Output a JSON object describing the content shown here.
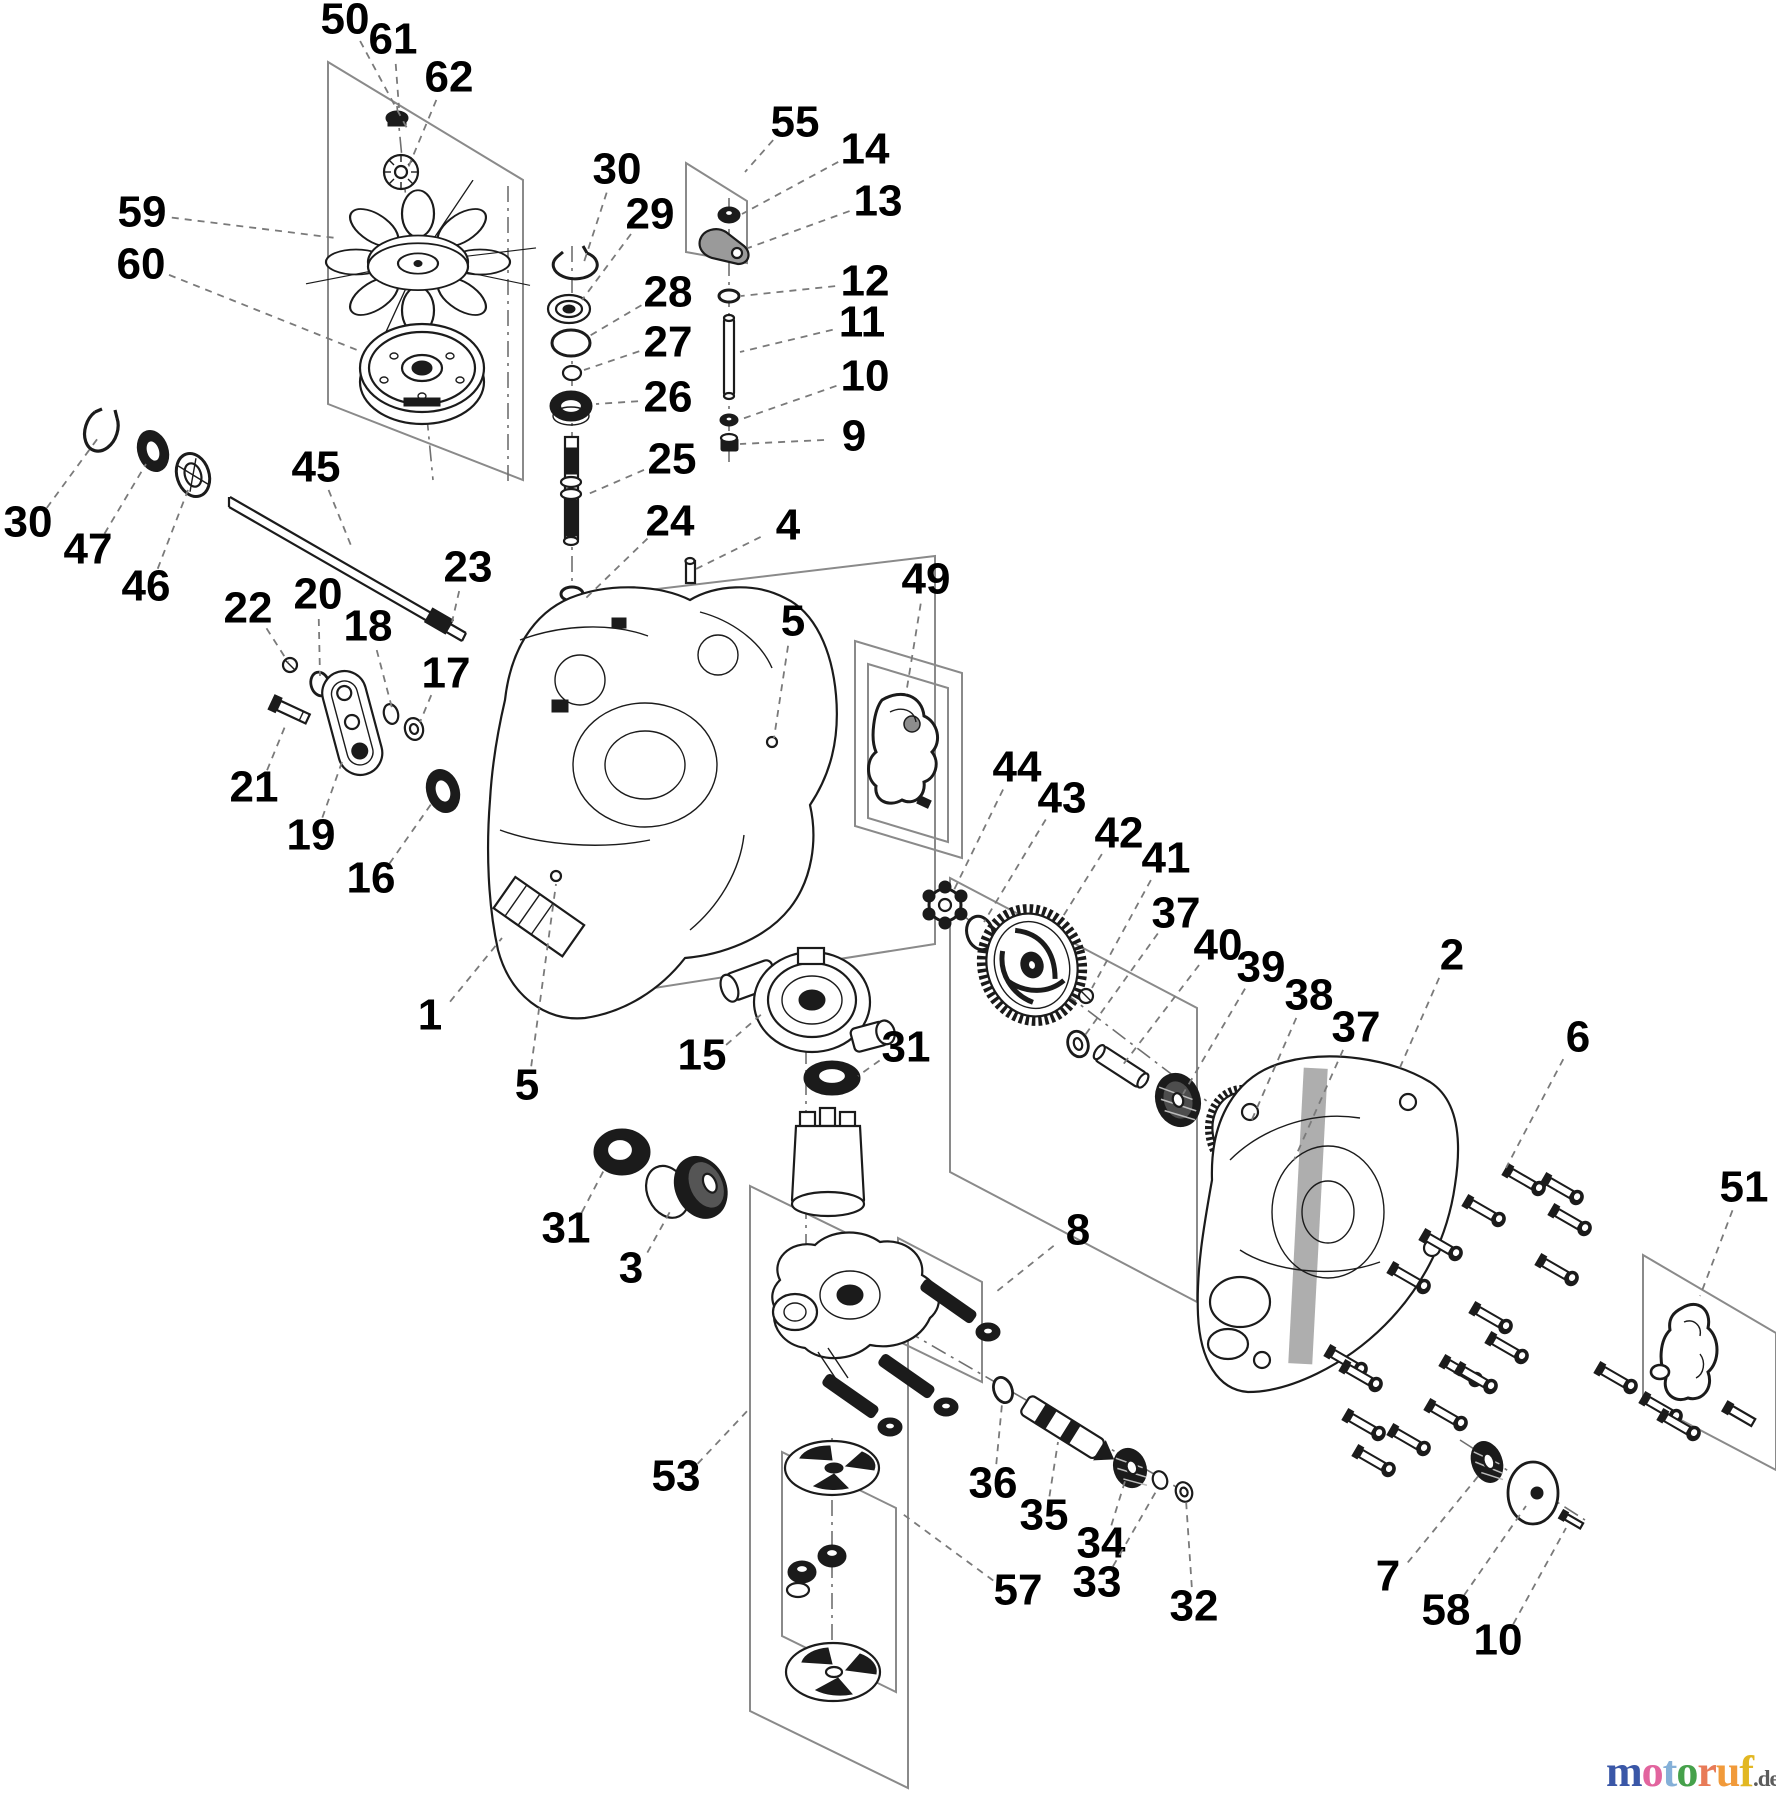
{
  "diagram": {
    "type": "exploded-parts-diagram",
    "description": "Hydrostatic transaxle exploded view with numbered part callouts",
    "background": "#ffffff",
    "line_color": "#1b1b1b",
    "leader_color": "#7a7a7a",
    "box_color": "#8a8a8a"
  },
  "callouts": [
    {
      "label": "50",
      "x": 345,
      "y": 22,
      "tx": 408,
      "ty": 130
    },
    {
      "label": "61",
      "x": 393,
      "y": 42,
      "tx": 399,
      "ty": 108
    },
    {
      "label": "62",
      "x": 449,
      "y": 80,
      "tx": 408,
      "ty": 168
    },
    {
      "label": "59",
      "x": 142,
      "y": 215,
      "tx": 336,
      "ty": 238
    },
    {
      "label": "60",
      "x": 141,
      "y": 267,
      "tx": 362,
      "ty": 352
    },
    {
      "label": "30",
      "x": 617,
      "y": 172,
      "tx": 584,
      "ty": 262
    },
    {
      "label": "29",
      "x": 650,
      "y": 217,
      "tx": 582,
      "ty": 300
    },
    {
      "label": "28",
      "x": 668,
      "y": 295,
      "tx": 586,
      "ty": 338
    },
    {
      "label": "27",
      "x": 668,
      "y": 345,
      "tx": 584,
      "ty": 370
    },
    {
      "label": "26",
      "x": 668,
      "y": 400,
      "tx": 596,
      "ty": 404
    },
    {
      "label": "25",
      "x": 672,
      "y": 462,
      "tx": 586,
      "ty": 495
    },
    {
      "label": "24",
      "x": 670,
      "y": 524,
      "tx": 586,
      "ty": 598
    },
    {
      "label": "23",
      "x": 468,
      "y": 570,
      "tx": 452,
      "ty": 622
    },
    {
      "label": "55",
      "x": 795,
      "y": 125,
      "tx": 745,
      "ty": 172
    },
    {
      "label": "14",
      "x": 865,
      "y": 152,
      "tx": 742,
      "ty": 214
    },
    {
      "label": "13",
      "x": 878,
      "y": 204,
      "tx": 748,
      "ty": 248
    },
    {
      "label": "12",
      "x": 865,
      "y": 284,
      "tx": 741,
      "ty": 296
    },
    {
      "label": "11",
      "x": 862,
      "y": 325,
      "tx": 740,
      "ty": 352
    },
    {
      "label": "10",
      "x": 865,
      "y": 379,
      "tx": 739,
      "ty": 420
    },
    {
      "label": "9",
      "x": 854,
      "y": 439,
      "tx": 740,
      "ty": 444
    },
    {
      "label": "4",
      "x": 788,
      "y": 528,
      "tx": 694,
      "ty": 570
    },
    {
      "label": "5",
      "x": 793,
      "y": 624,
      "tx": 774,
      "ty": 738
    },
    {
      "label": "49",
      "x": 926,
      "y": 582,
      "tx": 906,
      "ty": 694
    },
    {
      "label": "44",
      "x": 1017,
      "y": 770,
      "tx": 952,
      "ty": 894
    },
    {
      "label": "43",
      "x": 1062,
      "y": 801,
      "tx": 984,
      "ty": 922
    },
    {
      "label": "42",
      "x": 1119,
      "y": 836,
      "tx": 1062,
      "ty": 918
    },
    {
      "label": "41",
      "x": 1166,
      "y": 861,
      "tx": 1092,
      "ty": 988
    },
    {
      "label": "37",
      "x": 1176,
      "y": 916,
      "tx": 1083,
      "ty": 1038
    },
    {
      "label": "40",
      "x": 1218,
      "y": 948,
      "tx": 1122,
      "ty": 1066
    },
    {
      "label": "39",
      "x": 1261,
      "y": 970,
      "tx": 1183,
      "ty": 1094
    },
    {
      "label": "38",
      "x": 1309,
      "y": 998,
      "tx": 1250,
      "ty": 1124
    },
    {
      "label": "37",
      "x": 1356,
      "y": 1030,
      "tx": 1294,
      "ty": 1160
    },
    {
      "label": "2",
      "x": 1452,
      "y": 958,
      "tx": 1398,
      "ty": 1072
    },
    {
      "label": "6",
      "x": 1578,
      "y": 1040,
      "tx": 1506,
      "ty": 1168
    },
    {
      "label": "51",
      "x": 1744,
      "y": 1190,
      "tx": 1700,
      "ty": 1296
    },
    {
      "label": "30",
      "x": 28,
      "y": 525,
      "tx": 98,
      "ty": 438
    },
    {
      "label": "47",
      "x": 88,
      "y": 552,
      "tx": 146,
      "ty": 464
    },
    {
      "label": "46",
      "x": 146,
      "y": 589,
      "tx": 188,
      "ty": 490
    },
    {
      "label": "45",
      "x": 316,
      "y": 470,
      "tx": 352,
      "ty": 548
    },
    {
      "label": "22",
      "x": 248,
      "y": 611,
      "tx": 288,
      "ty": 662
    },
    {
      "label": "20",
      "x": 318,
      "y": 597,
      "tx": 320,
      "ty": 676
    },
    {
      "label": "18",
      "x": 368,
      "y": 629,
      "tx": 392,
      "ty": 708
    },
    {
      "label": "17",
      "x": 446,
      "y": 676,
      "tx": 420,
      "ty": 722
    },
    {
      "label": "21",
      "x": 254,
      "y": 790,
      "tx": 286,
      "ty": 724
    },
    {
      "label": "19",
      "x": 311,
      "y": 838,
      "tx": 342,
      "ty": 762
    },
    {
      "label": "16",
      "x": 371,
      "y": 881,
      "tx": 434,
      "ty": 800
    },
    {
      "label": "1",
      "x": 430,
      "y": 1018,
      "tx": 502,
      "ty": 938
    },
    {
      "label": "5",
      "x": 527,
      "y": 1088,
      "tx": 556,
      "ty": 884
    },
    {
      "label": "15",
      "x": 702,
      "y": 1058,
      "tx": 764,
      "ty": 1012
    },
    {
      "label": "31",
      "x": 906,
      "y": 1050,
      "tx": 858,
      "ty": 1076
    },
    {
      "label": "31",
      "x": 566,
      "y": 1231,
      "tx": 604,
      "ty": 1170
    },
    {
      "label": "3",
      "x": 631,
      "y": 1271,
      "tx": 672,
      "ty": 1208
    },
    {
      "label": "8",
      "x": 1078,
      "y": 1233,
      "tx": 996,
      "ty": 1292
    },
    {
      "label": "53",
      "x": 676,
      "y": 1479,
      "tx": 750,
      "ty": 1408
    },
    {
      "label": "36",
      "x": 993,
      "y": 1486,
      "tx": 1002,
      "ty": 1404
    },
    {
      "label": "35",
      "x": 1044,
      "y": 1518,
      "tx": 1058,
      "ty": 1442
    },
    {
      "label": "34",
      "x": 1101,
      "y": 1546,
      "tx": 1126,
      "ty": 1478
    },
    {
      "label": "33",
      "x": 1097,
      "y": 1585,
      "tx": 1158,
      "ty": 1488
    },
    {
      "label": "32",
      "x": 1194,
      "y": 1609,
      "tx": 1186,
      "ty": 1500
    },
    {
      "label": "57",
      "x": 1018,
      "y": 1593,
      "tx": 900,
      "ty": 1512
    },
    {
      "label": "7",
      "x": 1388,
      "y": 1579,
      "tx": 1480,
      "ty": 1474
    },
    {
      "label": "58",
      "x": 1446,
      "y": 1613,
      "tx": 1526,
      "ty": 1506
    },
    {
      "label": "10",
      "x": 1498,
      "y": 1643,
      "tx": 1566,
      "ty": 1528
    }
  ],
  "group_boxes": [
    {
      "name": "box-fan-group-50",
      "points": "328,62 523,180 523,480 328,404"
    },
    {
      "name": "box-bracket-group-55",
      "points": "686,163 747,201 747,263 686,252"
    },
    {
      "name": "box-gasket-49-outer",
      "points": "855,641 962,673 962,858 855,826"
    },
    {
      "name": "box-gasket-49-inner",
      "points": "868,664 948,688 948,842 868,818"
    },
    {
      "name": "box-housing-main",
      "points": "565,600 935,556 935,944 565,1002"
    },
    {
      "name": "box-gear-group-42",
      "points": "950,878 1197,1008 1197,1302 950,1172"
    },
    {
      "name": "box-gasket-group-51",
      "points": "1643,1255 1776,1333 1776,1470 1643,1400"
    },
    {
      "name": "box-pump-group-53",
      "points": "750,1186 908,1263 908,1788 750,1711"
    },
    {
      "name": "box-filter-group-57",
      "points": "782,1452 896,1508 896,1692 782,1636"
    },
    {
      "name": "box-bolt-group-8",
      "points": "898,1238 982,1282 982,1382 898,1341"
    }
  ],
  "axis_lines": [
    [
      508,
      186,
      508,
      482
    ],
    [
      397,
      106,
      433,
      480
    ],
    [
      572,
      246,
      572,
      644
    ],
    [
      729,
      198,
      729,
      468
    ],
    [
      806,
      1048,
      806,
      1346
    ],
    [
      832,
      1438,
      832,
      1706
    ],
    [
      905,
      1330,
      1185,
      1492
    ],
    [
      940,
      898,
      1300,
      1172
    ],
    [
      1460,
      1440,
      1585,
      1520
    ]
  ],
  "bolts": [
    [
      1510,
      1172
    ],
    [
      1548,
      1181
    ],
    [
      1470,
      1203
    ],
    [
      1556,
      1212
    ],
    [
      1427,
      1237
    ],
    [
      1543,
      1262
    ],
    [
      1395,
      1270
    ],
    [
      1477,
      1310
    ],
    [
      1493,
      1340
    ],
    [
      1332,
      1353
    ],
    [
      1447,
      1363
    ],
    [
      1347,
      1368
    ],
    [
      1462,
      1370
    ],
    [
      1432,
      1407
    ],
    [
      1350,
      1417
    ],
    [
      1395,
      1432
    ],
    [
      1360,
      1453
    ],
    [
      1602,
      1370
    ],
    [
      1647,
      1400
    ],
    [
      1665,
      1417
    ]
  ],
  "watermark": {
    "letters": [
      {
        "ch": "m",
        "color": "#3a57a7"
      },
      {
        "ch": "o",
        "color": "#e2649e"
      },
      {
        "ch": "t",
        "color": "#85b0d8"
      },
      {
        "ch": "o",
        "color": "#46a14b"
      },
      {
        "ch": "r",
        "color": "#e87b58"
      },
      {
        "ch": "u",
        "color": "#f19a3a"
      },
      {
        "ch": "f",
        "color": "#e2b722"
      }
    ],
    "suffix": ".de",
    "suffix_color": "#5c5c5c"
  }
}
